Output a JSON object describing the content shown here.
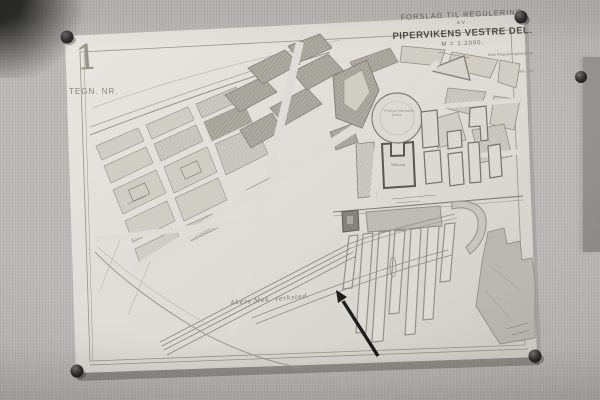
{
  "sheet": {
    "drawing_number": "1",
    "drawing_number_caption": "TEGN. NR.",
    "title": {
      "line1": "FORSLAG TIL REGULERING",
      "line2": "AV",
      "line3": "PIPERVIKENS VESTRE DEL.",
      "scale": "M = 1:2000.",
      "signature_line1": "Oslo Reguleringsvesenet",
      "signature_line2": "febr. -47"
    },
    "labels": {
      "street_top": "MUNKEDAMSVEIEN",
      "plaza_line1": "Fridtjof Nansens",
      "plaza_line2": "plass",
      "city_hall": "Rådhuset",
      "shipyard": "Akers Mek. verksted."
    }
  },
  "colors": {
    "wall": "#b6b4b0",
    "paper": "#dcdad3",
    "ink": "#56534c",
    "block_light": "#ccc9c1",
    "block_dark_hatch": "#a7a49b",
    "pushpin": "#1a1918",
    "arrow": "#0c0c0c"
  }
}
